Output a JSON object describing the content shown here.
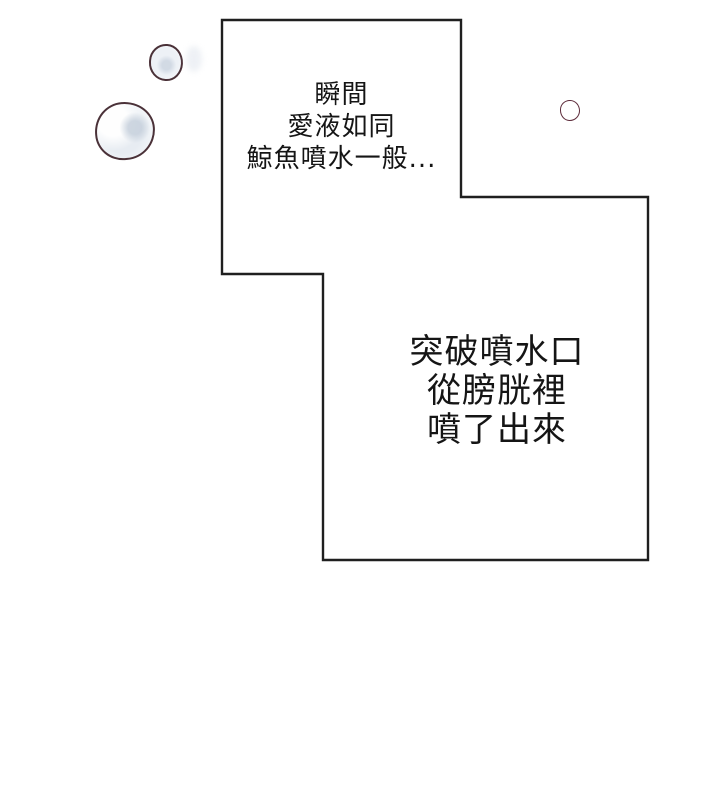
{
  "balloons": {
    "top": {
      "lines": [
        "瞬間",
        "愛液如同",
        "鯨魚噴水一般..."
      ]
    },
    "bottom": {
      "lines": [
        "突破噴水口",
        "從膀胱裡",
        "噴了出來"
      ]
    }
  },
  "colors": {
    "background": "#ffffff",
    "panel_fill": "#ffffff",
    "panel_border": "#1f1f1f",
    "text_color": "#151515",
    "bubble_outline": "#4a3138",
    "bubble_shade": "#c6d0dc",
    "small_circle_outline": "#5d2b3a"
  }
}
